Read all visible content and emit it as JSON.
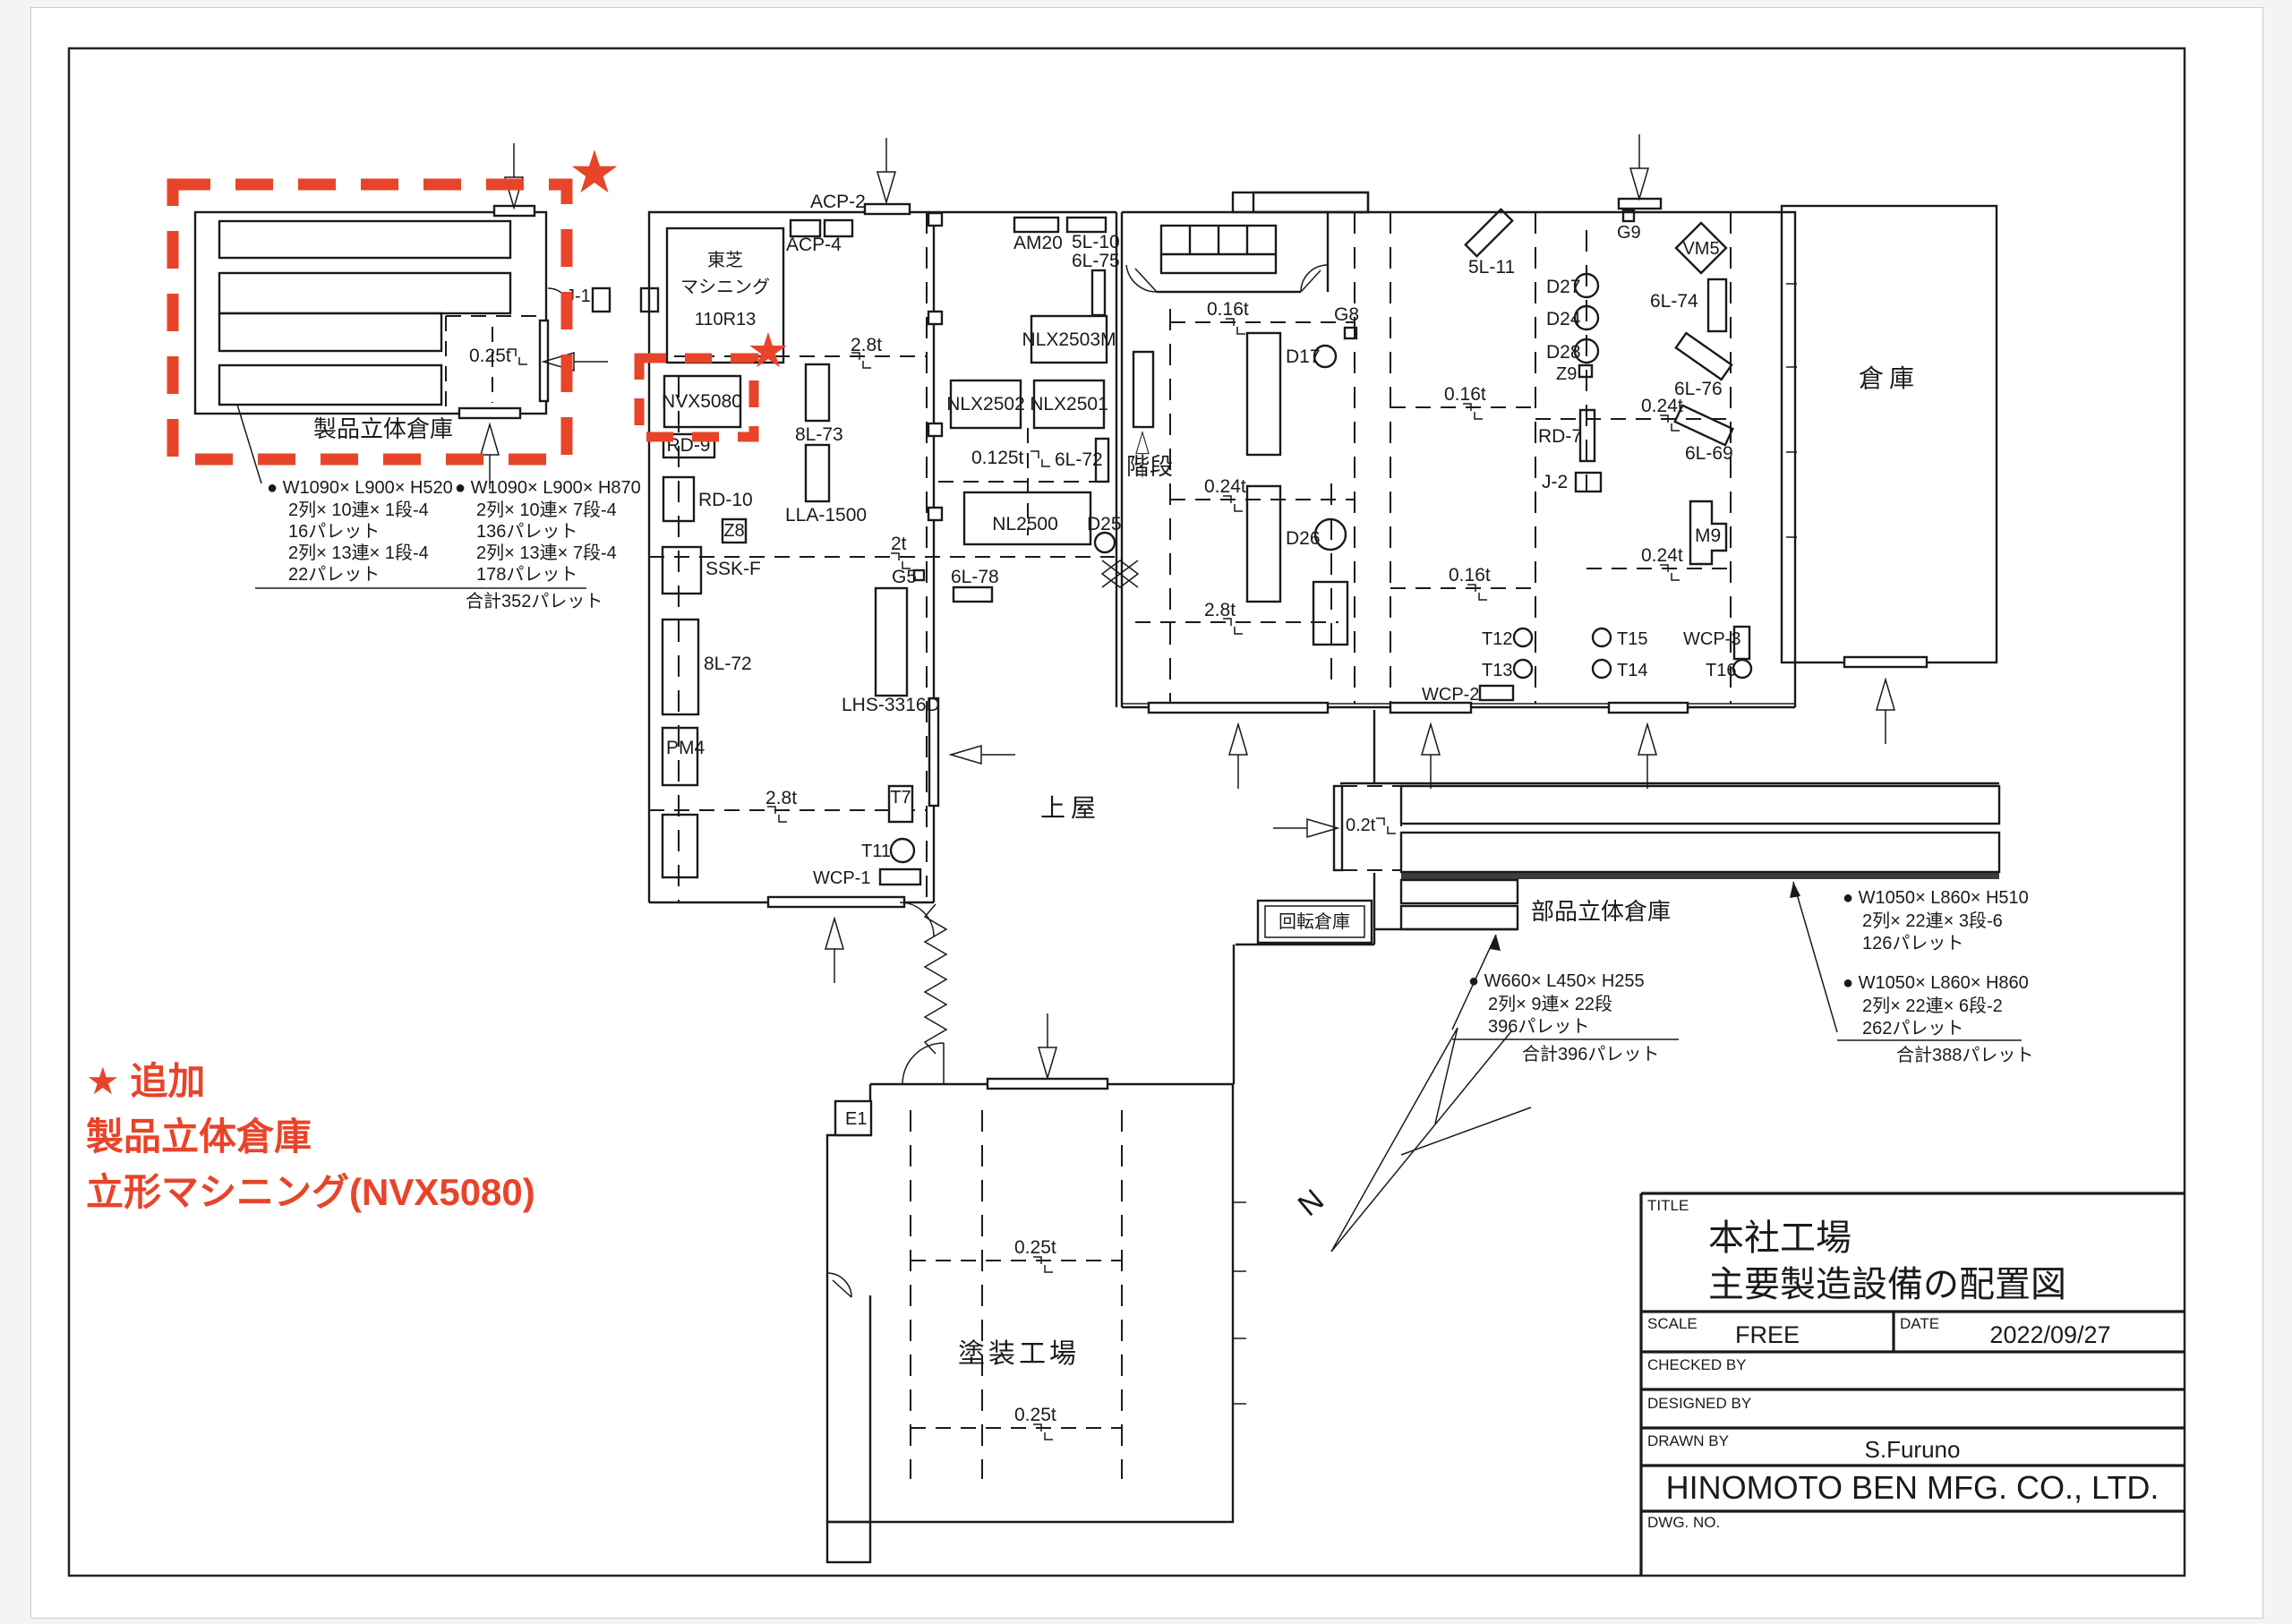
{
  "drawing": {
    "red_accent": "#e8442a",
    "line_color": "#1a1a1a"
  },
  "product_warehouse": {
    "label": "製品立体倉庫",
    "crane": "0.25t",
    "door": "J-1",
    "annotation": {
      "col1": [
        "● W1090× L900× H520",
        "2列× 10連× 1段-4",
        "16パレット",
        "2列× 13連× 1段-4",
        "22パレット"
      ],
      "col2": [
        "● W1090× L900× H870",
        "2列× 10連× 7段-4",
        "136パレット",
        "2列× 13連× 7段-4",
        "178パレット"
      ],
      "total": "合計352パレット"
    }
  },
  "machine_shop": {
    "toshiba": [
      "東芝",
      "マシニング",
      "110R13"
    ],
    "machines": {
      "acp2": "ACP-2",
      "acp4": "ACP-4",
      "nvx": "NVX5080",
      "rd9": "RD-9",
      "rd10": "RD-10",
      "z8": "Z8",
      "l8_73": "8L-73",
      "lla": "LLA-1500",
      "ssk": "SSK-F",
      "l8_72": "8L-72",
      "pm4": "PM4",
      "g5": "G5",
      "lhs": "LHS-3316D",
      "l6_78": "6L-78",
      "t7": "T7",
      "t11": "T11",
      "wcp1": "WCP-1"
    },
    "cranes": {
      "c28": "2.8t",
      "c2": "2t"
    }
  },
  "center_shop": {
    "machines": {
      "am20": "AM20",
      "l5_10": "5L-10",
      "l6_75": "6L-75",
      "nlx2503m": "NLX2503M",
      "nlx2502": "NLX2502",
      "nlx2501": "NLX2501",
      "l6_72": "6L-72",
      "nl2500": "NL2500",
      "d25": "D25"
    },
    "crane": "0.125t"
  },
  "stairs_label": "階段",
  "right_building": {
    "machines": {
      "l5_11": "5L-11",
      "d17": "D17",
      "d26": "D26",
      "d27": "D27",
      "d24": "D24",
      "d28": "D28",
      "z9": "Z9",
      "rd7": "RD-7",
      "j2": "J-2",
      "g8": "G8",
      "g9": "G9",
      "vm5": "VM5",
      "l6_74": "6L-74",
      "l6_76": "6L-76",
      "l6_69": "6L-69",
      "m9": "M9",
      "t12": "T12",
      "t13": "T13",
      "t14": "T14",
      "t15": "T15",
      "t16": "T16",
      "wcp2": "WCP-2",
      "wcp3": "WCP-3"
    },
    "cranes": {
      "c016": "0.16t",
      "c024": "0.24t",
      "c28": "2.8t"
    }
  },
  "warehouse_label": "倉庫",
  "canopy_label": "上屋",
  "rotary_label": "回転倉庫",
  "parts_warehouse": {
    "label": "部品立体倉庫",
    "crane": "0.2t",
    "annotation_small": {
      "lines": [
        "● W660× L450× H255",
        "2列× 9連× 22段",
        "396パレット"
      ],
      "total": "合計396パレット"
    },
    "annotation_large": {
      "group1": [
        "● W1050× L860× H510",
        "2列× 22連× 3段-6",
        "126パレット"
      ],
      "group2": [
        "● W1050× L860× H860",
        "2列× 22連× 6段-2",
        "262パレット"
      ],
      "total": "合計388パレット"
    }
  },
  "paint_shop": {
    "label": "塗装工場",
    "e1": "E1",
    "crane": "0.25t"
  },
  "compass": "N",
  "red_notes": {
    "star": "★",
    "line1": "★ 追加",
    "line2": "製品立体倉庫",
    "line3": "立形マシニング(NVX5080)"
  },
  "title_block": {
    "title_label": "TITLE",
    "title_line1": "本社工場",
    "title_line2": "主要製造設備の配置図",
    "scale_label": "SCALE",
    "scale_value": "FREE",
    "date_label": "DATE",
    "date_value": "2022/09/27",
    "checked_label": "CHECKED BY",
    "designed_label": "DESIGNED BY",
    "drawn_label": "DRAWN BY",
    "drawn_value": "S.Furuno",
    "company": "HINOMOTO BEN MFG. CO., LTD.",
    "dwg_label": "DWG. NO."
  }
}
